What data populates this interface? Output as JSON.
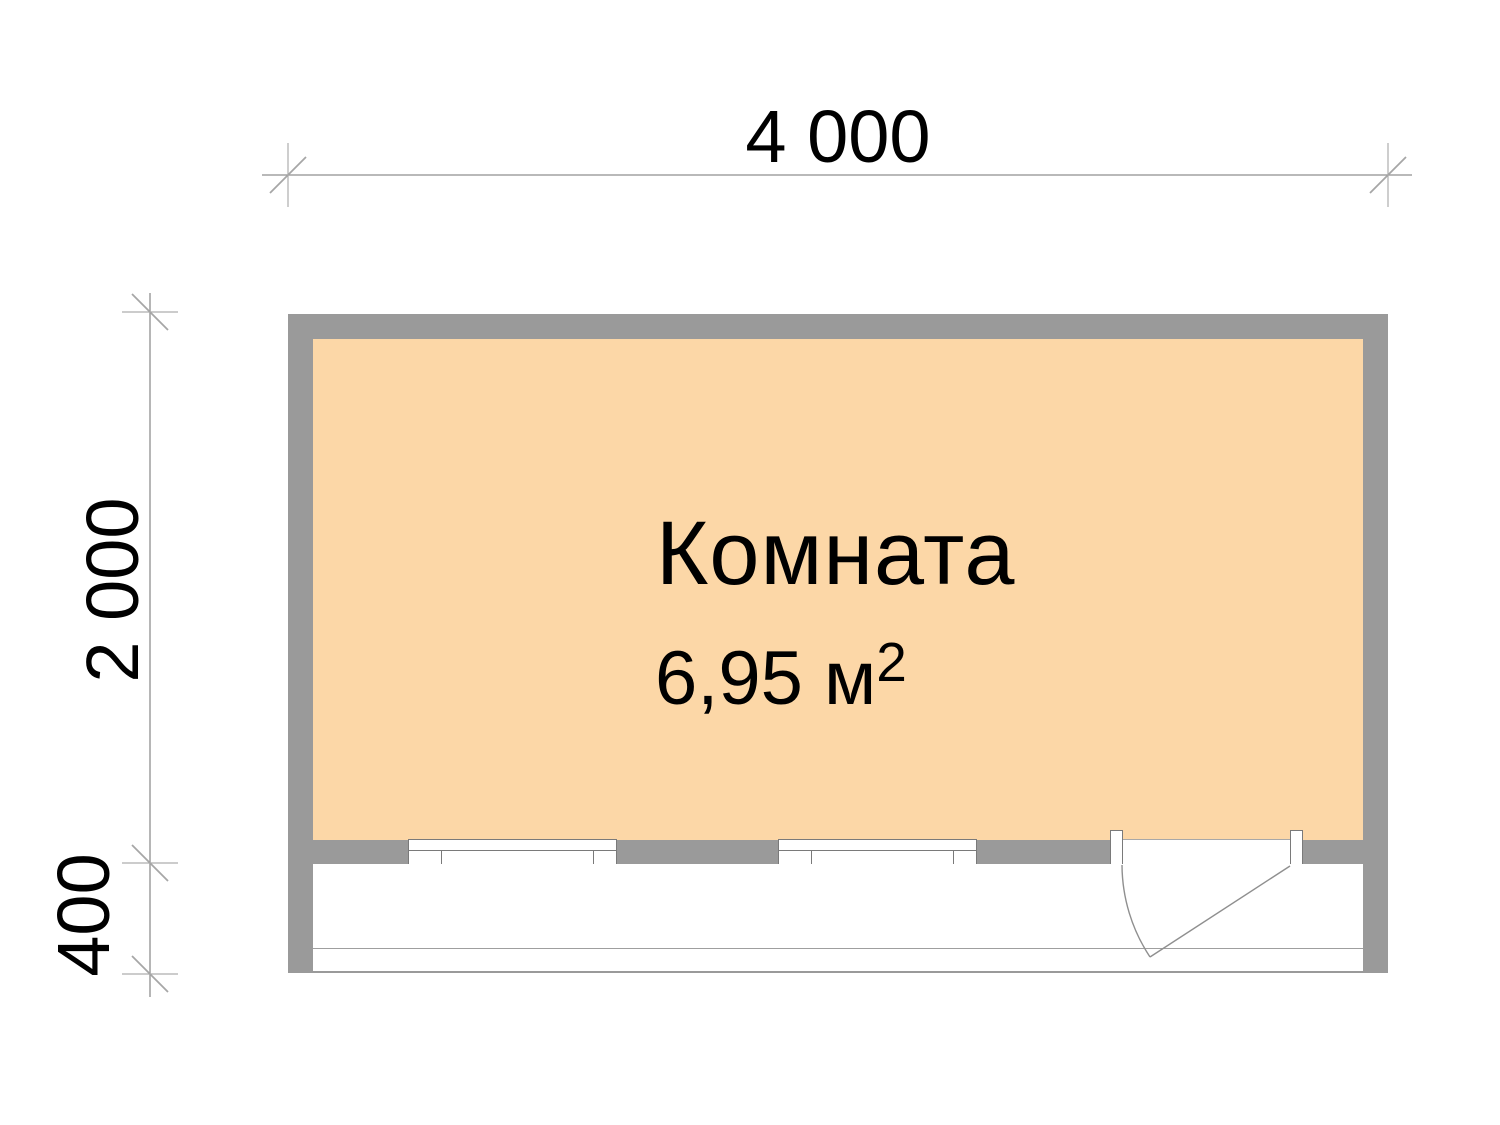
{
  "dims": {
    "width": "4 000",
    "height": "2 000",
    "depth": "400"
  },
  "room": {
    "name": "Комната",
    "area": "6,95 м",
    "area_sup": "2"
  },
  "colors": {
    "room_fill": "#FCD7A7",
    "wall_gray": "#9A9A9A",
    "dim_line_gray": "#8f8f8f",
    "text": "#000000"
  }
}
